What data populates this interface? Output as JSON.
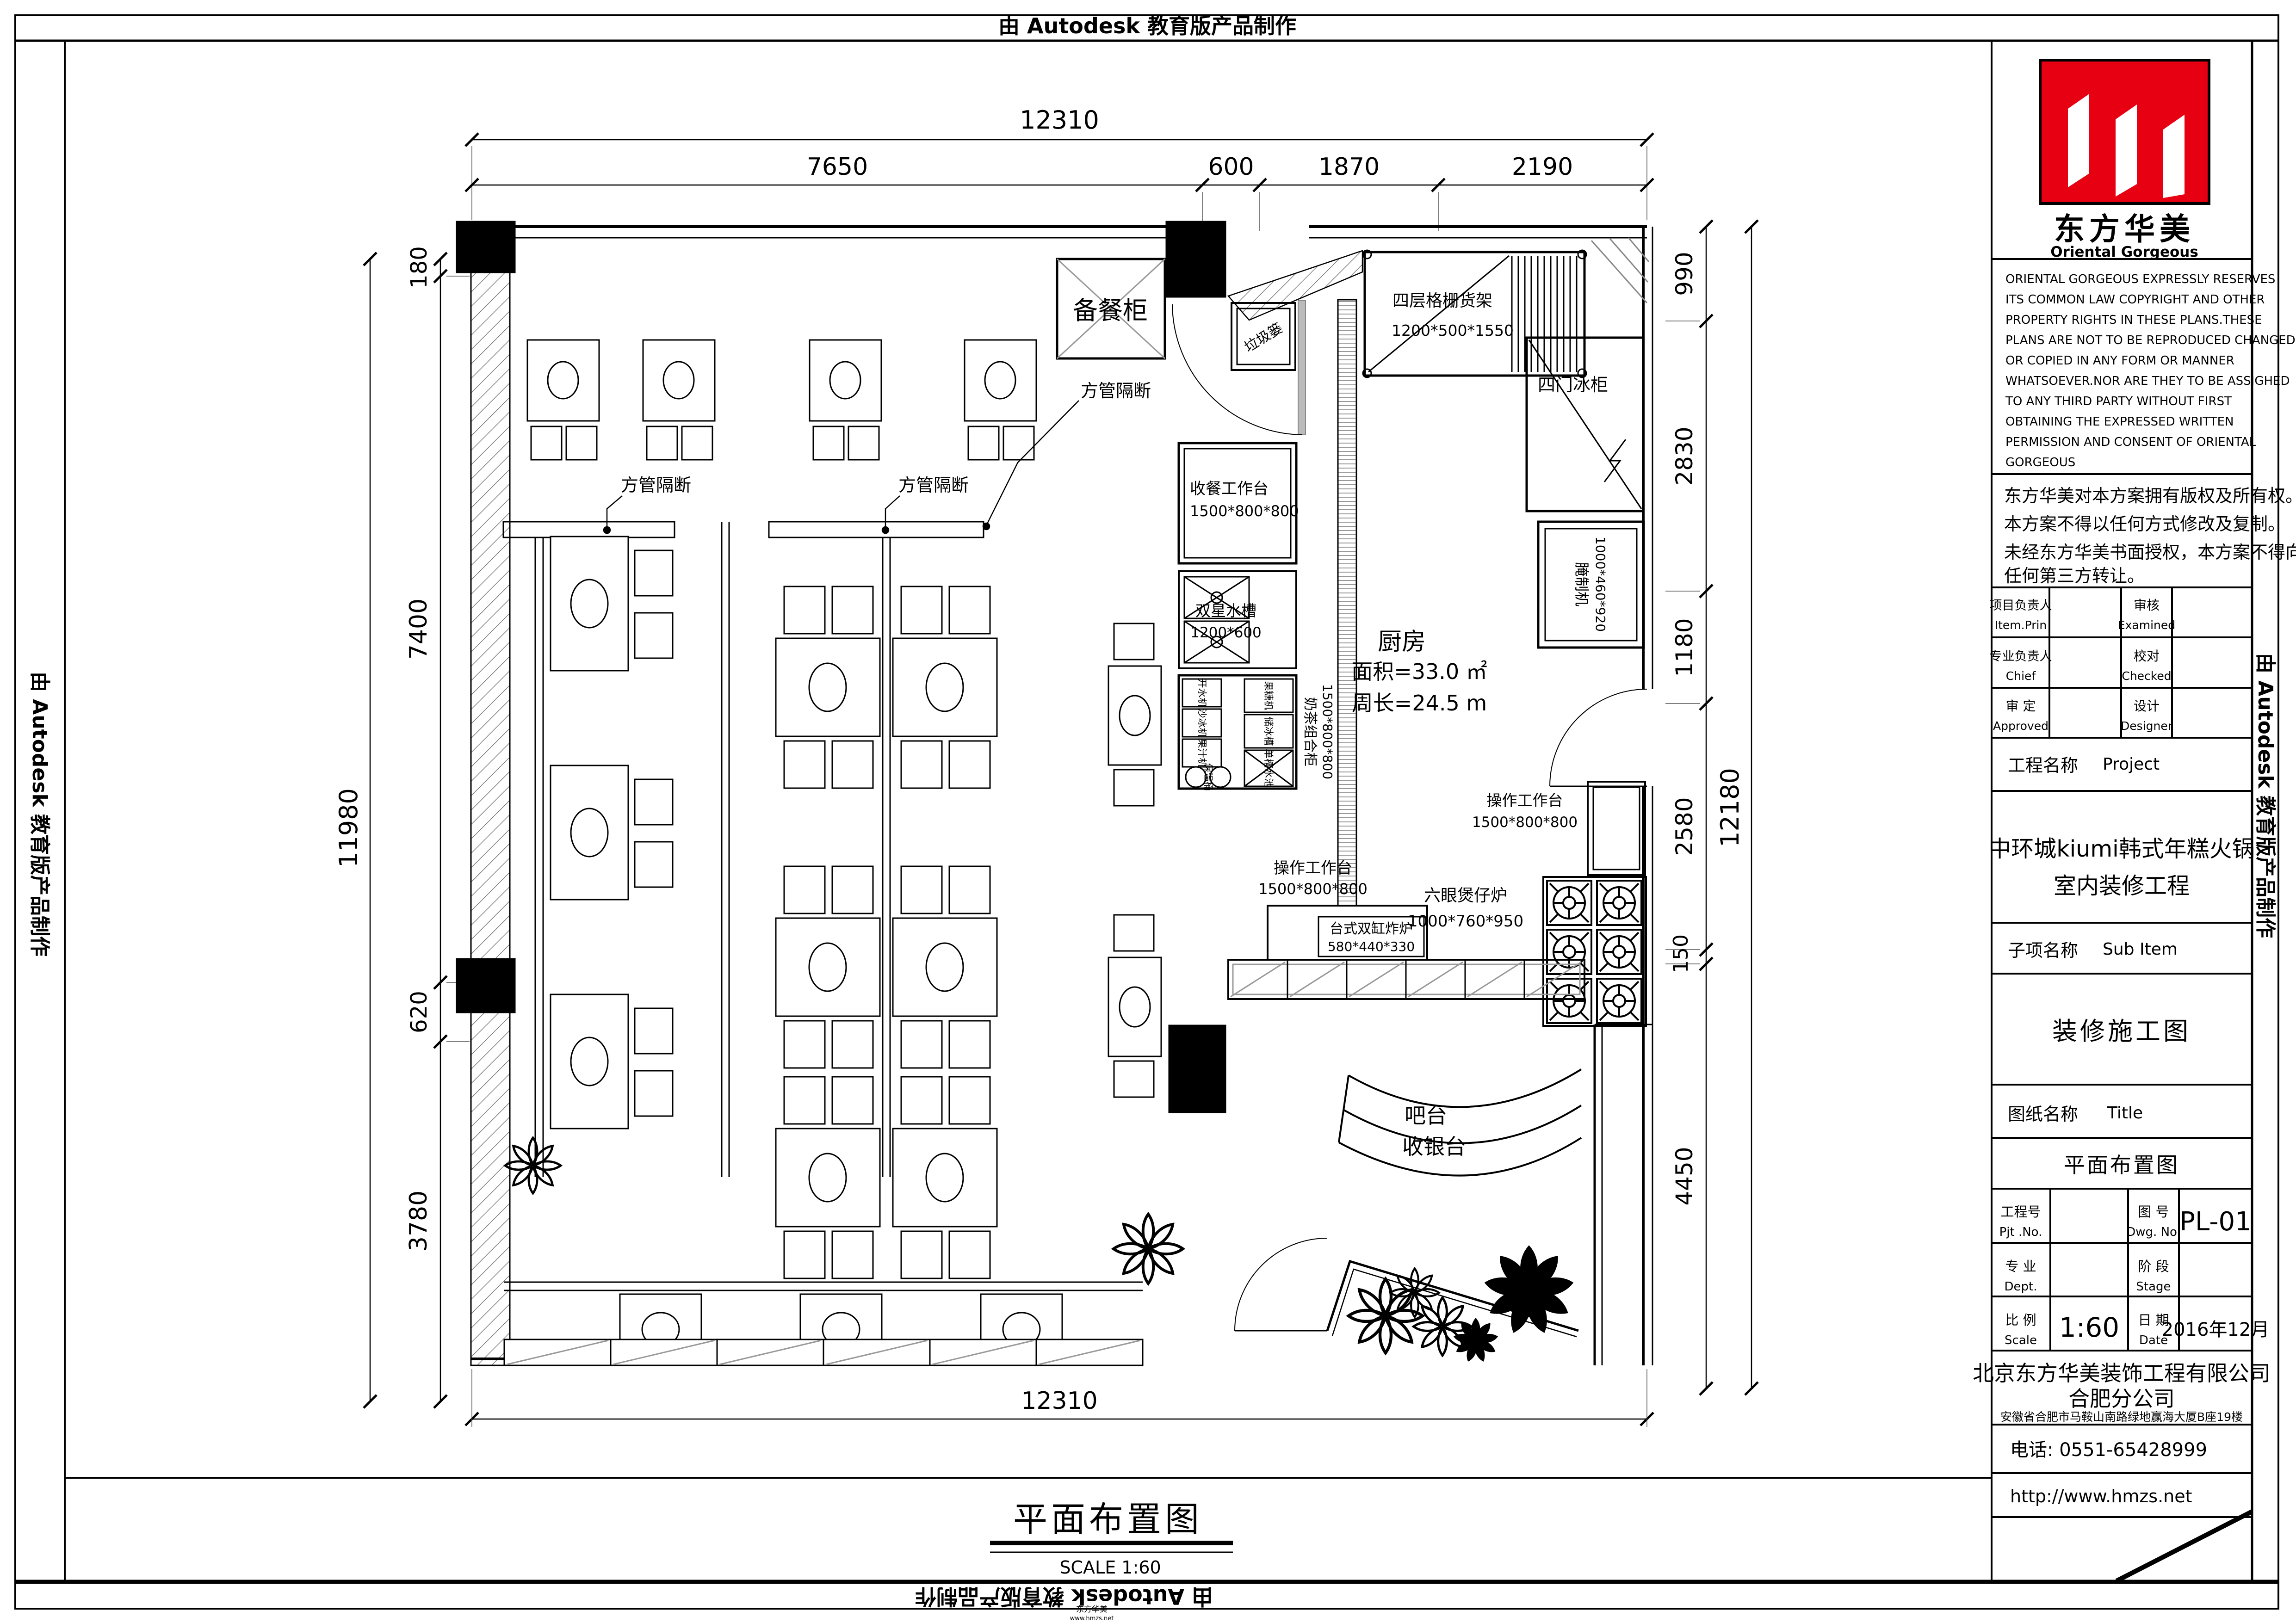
{
  "banner": {
    "text": "由 Autodesk 教育版产品制作"
  },
  "dims": {
    "top_total": "12310",
    "top_segments": [
      "7650",
      "600",
      "1870",
      "2190"
    ],
    "left_total": "11980",
    "left_segments": [
      "180",
      "7400",
      "620",
      "3780"
    ],
    "right_segments": [
      "990",
      "2830",
      "1180",
      "2580",
      "150",
      "4450"
    ],
    "right_total": "12180",
    "bottom_total": "12310"
  },
  "plan": {
    "pantry_cabinet": "备餐柜",
    "trash_basket": "垃圾篓",
    "shelf_name": "四层格栅货架",
    "shelf_size": "1200*500*1550",
    "fridge": "四门冰柜",
    "marinator_name": "腌制机",
    "marinator_size": "1000*460*920",
    "worktable_name": "操作工作台",
    "worktable_size": "1500*800*800",
    "stove_name": "六眼煲仔炉",
    "stove_size": "1000*760*950",
    "fryer_name": "台式双缸炸炉",
    "fryer_size": "580*440*330",
    "collect_table_name": "收餐工作台",
    "collect_table_size": "1500*800*800",
    "sink_name": "双星水槽",
    "sink_size": "1200*600",
    "milktea_name": "奶茶组合柜",
    "milktea_size": "1500*800*800",
    "unit_water_boiler": "开水机",
    "unit_ice_blender": "沙冰机",
    "unit_juicer": "果汁机",
    "unit_thermal_barrel": "保温桶",
    "unit_fructose": "果糖机",
    "unit_ice_bin": "储冰槽",
    "unit_single_sink": "单槽水池",
    "partition_label": "方管隔断",
    "kitchen_name": "厨房",
    "kitchen_area": "面积=33.0 ㎡",
    "kitchen_perimeter": "周长=24.5 m",
    "bar_line1": "吧台",
    "bar_line2": "收银台"
  },
  "caption": {
    "title": "平面布置图",
    "scale": "SCALE  1:60"
  },
  "watermark": {
    "line1": "东方华美",
    "line2": "www.hmzs.net"
  },
  "titleblock": {
    "logo_cn": "东方华美",
    "logo_en": "Oriental Gorgeous",
    "copyright_en": [
      "ORIENTAL GORGEOUS EXPRESSLY RESERVES",
      "ITS COMMON LAW COPYRIGHT AND OTHER",
      "PROPERTY RIGHTS IN THESE PLANS.THESE",
      "PLANS ARE NOT TO BE REPRODUCED CHANGED",
      "OR COPIED IN ANY FORM OR MANNER",
      "WHATSOEVER.NOR ARE THEY TO BE ASSIGHED",
      "TO ANY THIRD PARTY WITHOUT FIRST",
      "OBTAINING THE EXPRESSED WRITTEN",
      "PERMISSION AND CONSENT OF ORIENTAL",
      "GORGEOUS"
    ],
    "copyright_cn": [
      "东方华美对本方案拥有版权及所有权。",
      "本方案不得以任何方式修改及复制。",
      "未经东方华美书面授权，本方案不得向",
      "任何第三方转让。"
    ],
    "item_prin_cn": "项目负责人",
    "item_prin_en": "Item.Prin",
    "examined_cn": "审核",
    "examined_en": "Examined",
    "chief_cn": "专业负责人",
    "chief_en": "Chief",
    "checked_cn": "校对",
    "checked_en": "Checked",
    "approved_cn": "审 定",
    "approved_en": "Approved",
    "designer_cn": "设计",
    "designer_en": "Designer",
    "project_label_cn": "工程名称",
    "project_label_en": "Project",
    "project_name_1": "中环城kiumi韩式年糕火锅",
    "project_name_2": "室内装修工程",
    "subitem_cn": "子项名称",
    "subitem_en": "Sub Item",
    "construction_set": "装修施工图",
    "sheet_label_cn": "图纸名称",
    "sheet_label_en": "Title",
    "sheet_name": "平面布置图",
    "pjt_cn": "工程号",
    "pjt_en": "Pjt .No.",
    "dwg_cn": "图 号",
    "dwg_en": "Dwg. No.",
    "dwg_no": "PL-01",
    "dept_cn": "专 业",
    "dept_en": "Dept.",
    "stage_cn": "阶 段",
    "stage_en": "Stage",
    "scale_cn": "比 例",
    "scale_en": "Scale",
    "scale_val": "1:60",
    "date_cn": "日 期",
    "date_en": "Date",
    "date_val": "2016年12月",
    "company_1": "北京东方华美装饰工程有限公司",
    "company_2": "合肥分公司",
    "address": "安徽省合肥市马鞍山南路绿地赢海大厦B座19楼",
    "phone": "电话: 0551-65428999",
    "website": "http://www.hmzs.net",
    "accent_red": "#e60012"
  }
}
